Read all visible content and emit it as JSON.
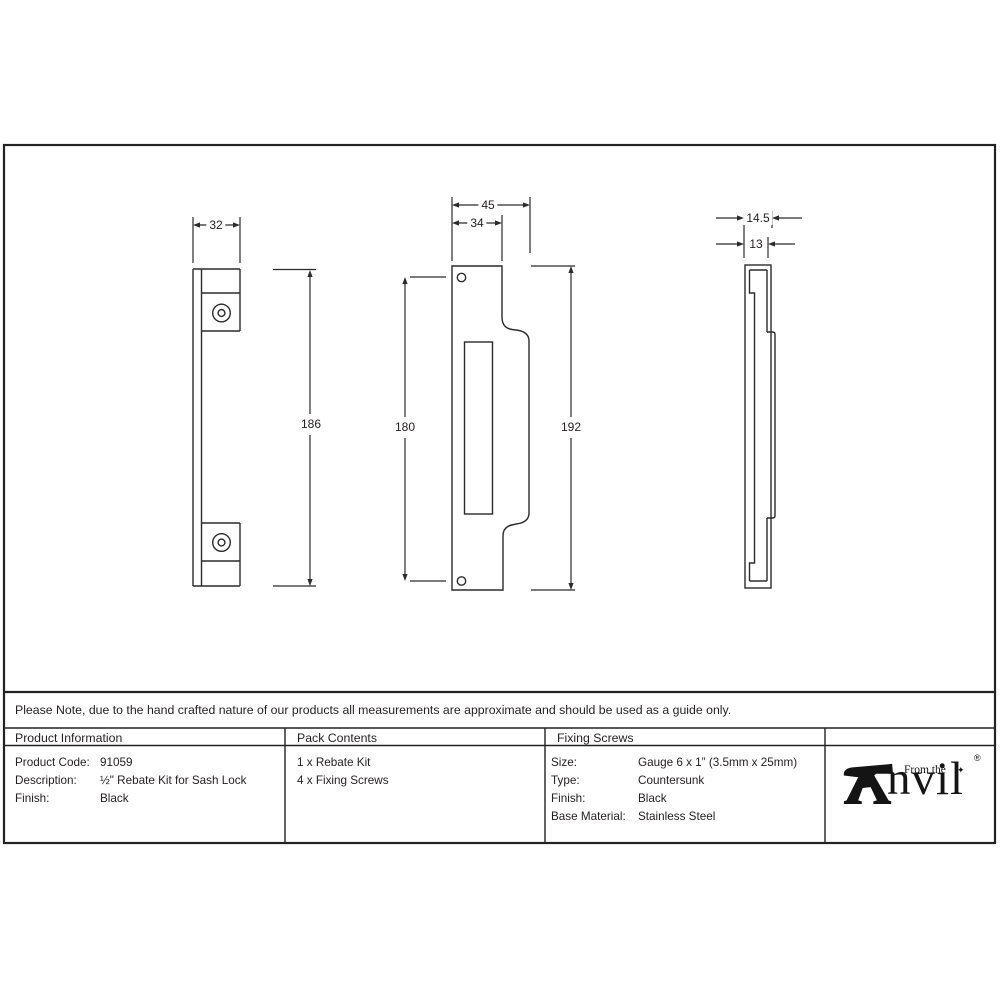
{
  "sheet": {
    "note": "Please Note, due to the hand crafted nature of our products all measurements are approximate and should be used as a guide only.",
    "table": {
      "product_information": {
        "header": "Product Information",
        "rows": [
          {
            "label": "Product Code:",
            "value": "91059"
          },
          {
            "label": "Description:",
            "value": "½\" Rebate Kit for Sash Lock"
          },
          {
            "label": "Finish:",
            "value": "Black"
          }
        ]
      },
      "pack_contents": {
        "header": "Pack Contents",
        "items": [
          "1 x Rebate Kit",
          "4 x Fixing Screws"
        ]
      },
      "fixing_screws": {
        "header": "Fixing Screws",
        "rows": [
          {
            "label": "Size:",
            "value": "Gauge 6 x 1” (3.5mm x 25mm)"
          },
          {
            "label": "Type:",
            "value": "Countersunk"
          },
          {
            "label": "Finish:",
            "value": "Black"
          },
          {
            "label": "Base Material:",
            "value": "Stainless Steel"
          }
        ]
      }
    },
    "logo": {
      "prefix": "From the",
      "name_rest": "nvil",
      "star": "✦",
      "registered": "®"
    },
    "dimensions": {
      "keep_width": "32",
      "keep_height": "186",
      "plate_width_overall": "45",
      "plate_width_face": "34",
      "plate_hole_centres": "180",
      "plate_height": "192",
      "side_depth_overall": "14.5",
      "side_depth_face": "13"
    }
  }
}
